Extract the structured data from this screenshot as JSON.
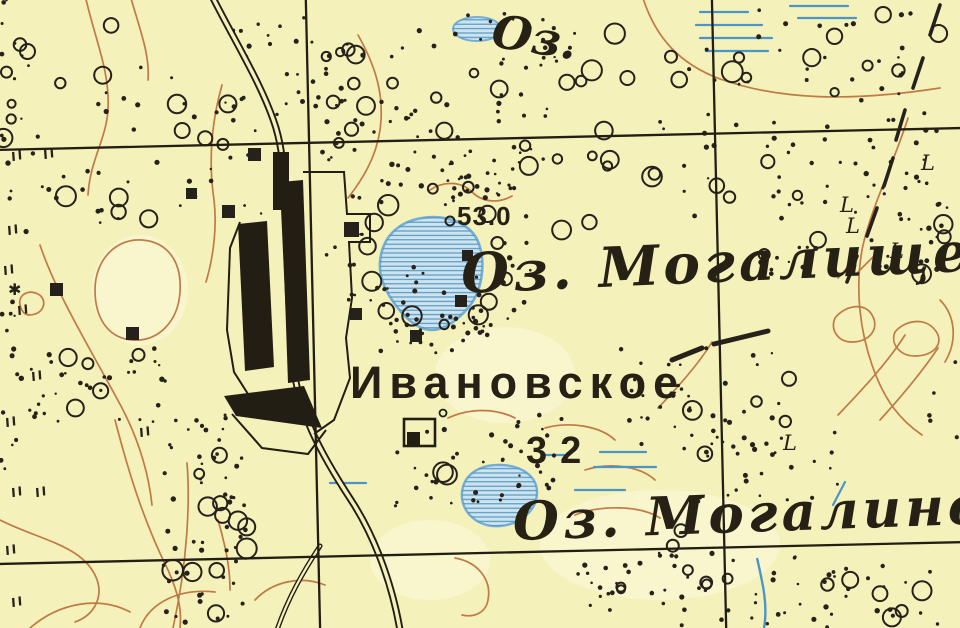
{
  "title": "Старая топографическая карта — Ивановское",
  "colors": {
    "paper": "#f5f1bb",
    "paper_light": "#fbf8d8",
    "ink": "#26211a",
    "contour_brown": "#c07a45",
    "water_fill": "#cde4f0",
    "water_hatch": "#4e92bc",
    "water_outline": "#74aed6",
    "marsh_blue": "#4a96c8"
  },
  "labels": {
    "lake_abbrev_top": "Оз.",
    "spot_height_1": "53.0",
    "lake_1_name": "Оз. Могалище",
    "village_name": "Ивановское",
    "spot_height_2": "32",
    "lake_2_name": "Оз. Могалино",
    "boundary_letter": "L",
    "star_symbol": "✱"
  },
  "map": {
    "grid": {
      "vertical_x": [
        313,
        719
      ],
      "horizontal_y": [
        139,
        553
      ],
      "rotation_deg": -1.3
    },
    "circle_clusters": [
      [
        60,
        70,
        55,
        50,
        6
      ],
      [
        215,
        112,
        45,
        35,
        5
      ],
      [
        100,
        195,
        50,
        28,
        4
      ],
      [
        358,
        100,
        45,
        48,
        5
      ],
      [
        520,
        80,
        85,
        55,
        8
      ],
      [
        648,
        48,
        45,
        38,
        4
      ],
      [
        790,
        62,
        75,
        50,
        6
      ],
      [
        898,
        42,
        45,
        30,
        4
      ],
      [
        618,
        172,
        55,
        45,
        5
      ],
      [
        762,
        205,
        65,
        55,
        6
      ],
      [
        935,
        255,
        18,
        35,
        3
      ],
      [
        530,
        148,
        28,
        18,
        3
      ],
      [
        88,
        380,
        55,
        32,
        5
      ],
      [
        208,
        480,
        28,
        55,
        5
      ],
      [
        196,
        572,
        32,
        45,
        4
      ],
      [
        256,
        522,
        20,
        28,
        3
      ],
      [
        332,
        36,
        18,
        18,
        2
      ],
      [
        455,
        468,
        18,
        15,
        2
      ],
      [
        678,
        598,
        65,
        28,
        5
      ],
      [
        850,
        598,
        75,
        28,
        6
      ],
      [
        740,
        418,
        55,
        40,
        5
      ],
      [
        18,
        115,
        16,
        25,
        3
      ],
      [
        350,
        112,
        38,
        35,
        3
      ],
      [
        575,
        235,
        25,
        20,
        2
      ],
      [
        660,
        545,
        40,
        30,
        3
      ]
    ],
    "dot_clusters": [
      [
        430,
        100,
        120,
        70,
        60
      ],
      [
        800,
        115,
        140,
        105,
        70
      ],
      [
        895,
        215,
        55,
        55,
        28
      ],
      [
        150,
        150,
        130,
        95,
        45
      ],
      [
        18,
        300,
        18,
        170,
        22
      ],
      [
        100,
        385,
        70,
        38,
        28
      ],
      [
        205,
        520,
        42,
        105,
        55
      ],
      [
        480,
        462,
        85,
        48,
        42
      ],
      [
        700,
        400,
        85,
        55,
        38
      ],
      [
        800,
        590,
        145,
        38,
        48
      ],
      [
        430,
        310,
        55,
        45,
        26
      ],
      [
        275,
        60,
        55,
        45,
        22
      ],
      [
        480,
        190,
        40,
        25,
        18
      ],
      [
        620,
        588,
        55,
        28,
        18
      ],
      [
        765,
        468,
        75,
        38,
        26
      ],
      [
        520,
        40,
        55,
        28,
        18
      ],
      [
        950,
        390,
        25,
        60,
        12
      ],
      [
        470,
        325,
        25,
        15,
        8
      ],
      [
        790,
        262,
        30,
        18,
        10
      ],
      [
        8,
        40,
        15,
        40,
        10
      ]
    ],
    "tree_ring": {
      "cx": 432,
      "cy": 258,
      "r_circles": 74,
      "n_circles": 14,
      "r_dots": 90,
      "n_dots": 46
    },
    "meadow_marks": [
      [
        12,
        152
      ],
      [
        44,
        150
      ],
      [
        8,
        226
      ],
      [
        4,
        266
      ],
      [
        18,
        306
      ],
      [
        32,
        372
      ],
      [
        6,
        418
      ],
      [
        12,
        488
      ],
      [
        36,
        488
      ],
      [
        6,
        546
      ],
      [
        12,
        598
      ],
      [
        140,
        428
      ]
    ],
    "building_squares": [
      [
        50,
        283,
        13
      ],
      [
        126,
        327,
        13
      ],
      [
        222,
        205,
        13
      ],
      [
        186,
        188,
        11
      ],
      [
        344,
        222,
        15
      ],
      [
        350,
        308,
        12
      ],
      [
        410,
        330,
        12
      ],
      [
        455,
        295,
        12
      ],
      [
        248,
        148,
        13
      ],
      [
        462,
        250,
        11
      ]
    ],
    "boundary_dashes": [
      [
        940,
        5,
        930,
        35
      ],
      [
        923,
        58,
        913,
        88
      ],
      [
        905,
        110,
        896,
        140
      ],
      [
        893,
        158,
        884,
        186
      ],
      [
        877,
        208,
        867,
        236
      ],
      [
        857,
        256,
        847,
        282
      ]
    ],
    "boundary_letter_positions": [
      [
        921,
        170
      ],
      [
        840,
        212
      ],
      [
        846,
        233
      ],
      [
        890,
        258
      ],
      [
        783,
        450
      ]
    ],
    "marsh_lines": [
      [
        700,
        12,
        748
      ],
      [
        696,
        25,
        762
      ],
      [
        700,
        38,
        772
      ],
      [
        706,
        51,
        768
      ],
      [
        790,
        6,
        848
      ],
      [
        798,
        18,
        856
      ],
      [
        600,
        452,
        646
      ],
      [
        594,
        467,
        656
      ],
      [
        575,
        490,
        625
      ],
      [
        545,
        455,
        567
      ],
      [
        330,
        483,
        366
      ]
    ],
    "marsh_slashes": [
      [
        833,
        505,
        845,
        482
      ]
    ],
    "scrub_strokes": [
      [
        672,
        360,
        702,
        348
      ],
      [
        714,
        344,
        768,
        331
      ]
    ],
    "spot_height_marker": {
      "x": 450,
      "y": 221,
      "r": 4.5
    },
    "star_position": [
      8,
      295
    ]
  }
}
